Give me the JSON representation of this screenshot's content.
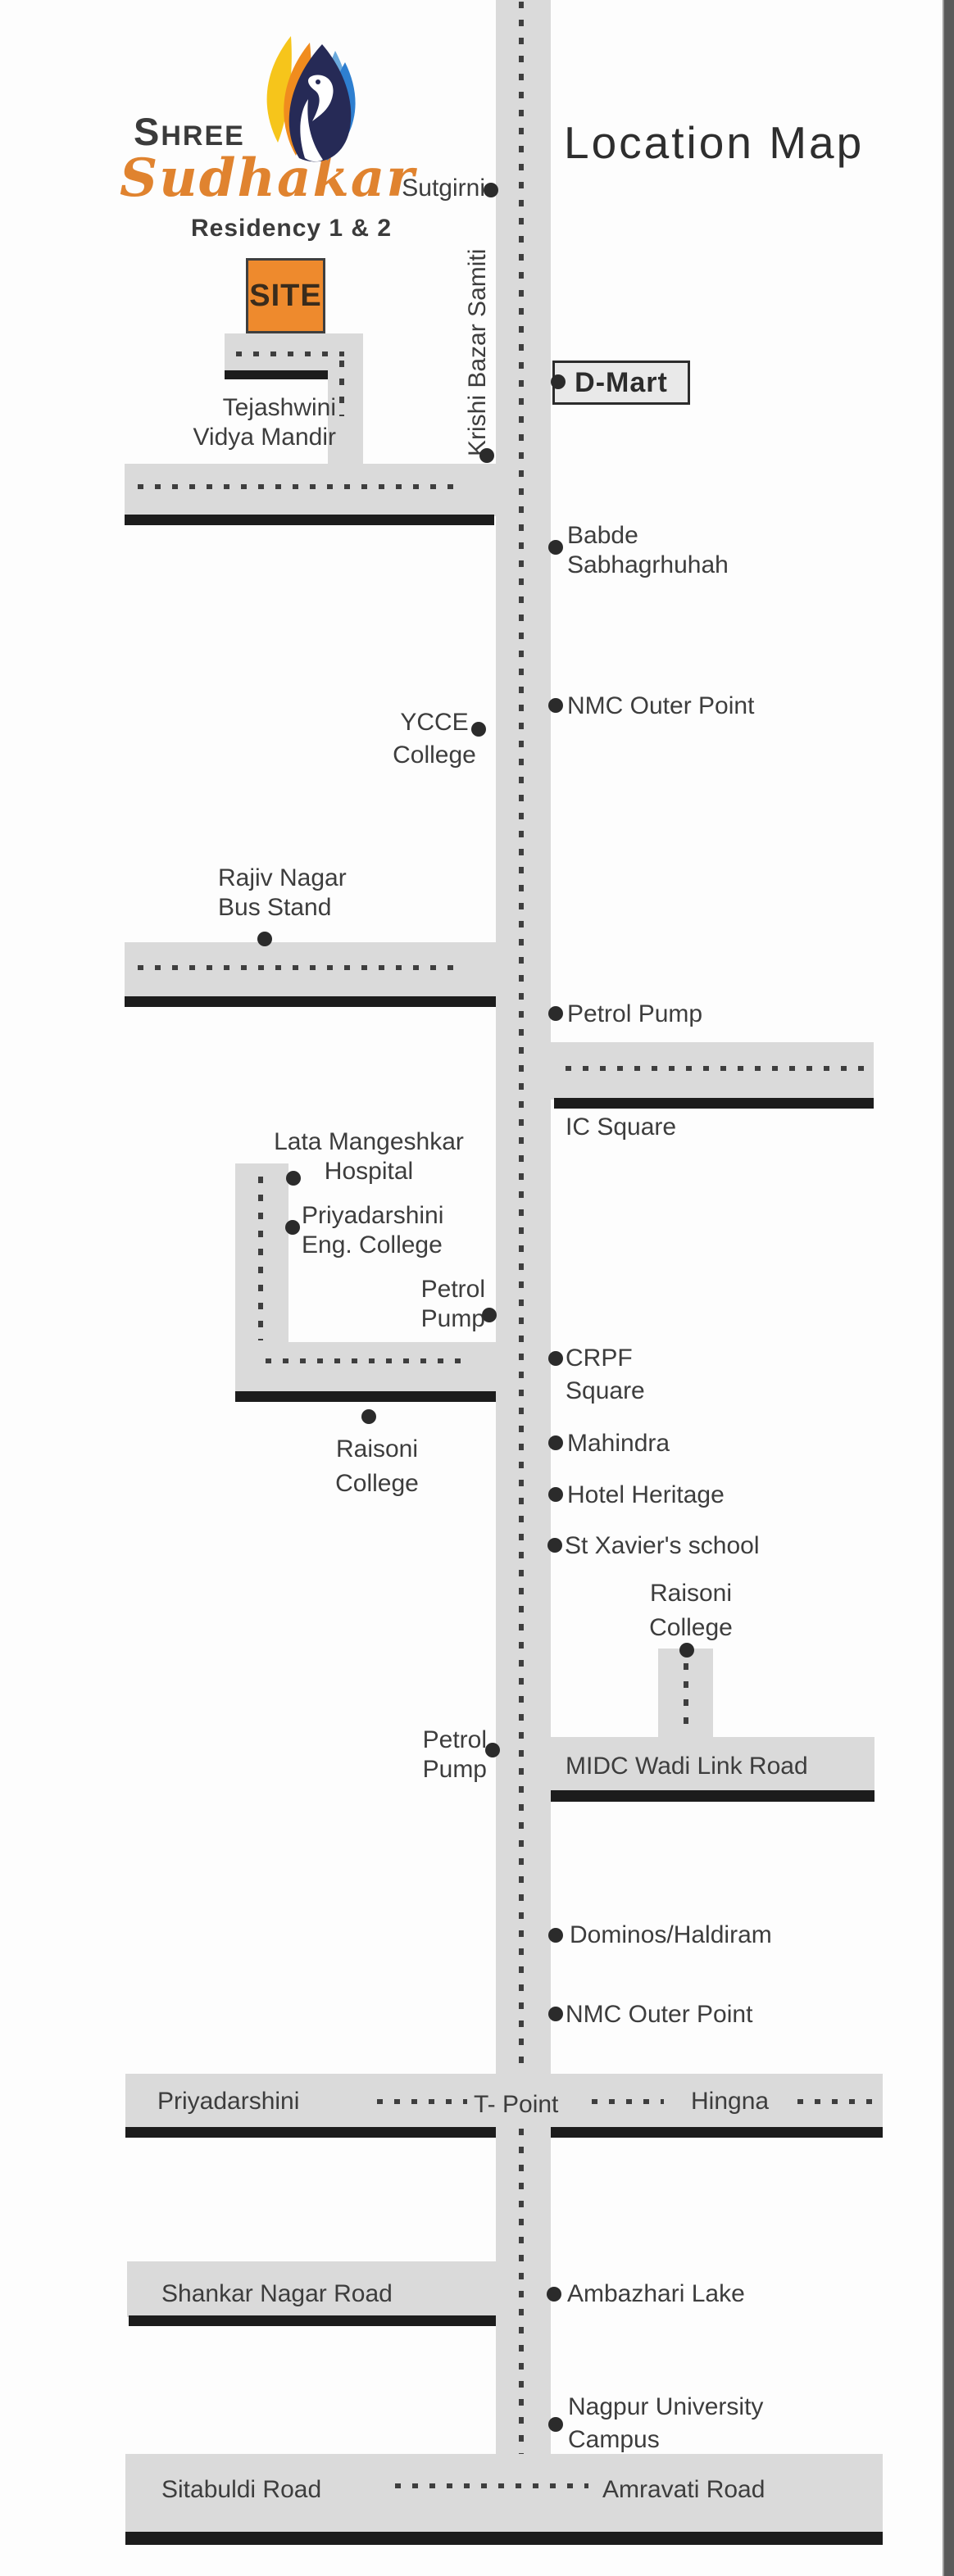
{
  "title": "Location Map",
  "branding": {
    "shree_initial": "S",
    "shree_rest": "HREE",
    "script": "Sudhakar",
    "residency": "Residency 1 & 2"
  },
  "site": {
    "label": "SITE"
  },
  "colors": {
    "road_fill": "#dadada",
    "black_line": "#1c1c1c",
    "dotted_line": "#3e3e3e",
    "bullet": "#2b2b2b",
    "text": "#3d3d3d",
    "site_orange": "#ee8a2d",
    "script_orange": "#e0832f",
    "logo_yellow": "#f6c51b",
    "logo_orange": "#f08c1e",
    "logo_navy": "#262a56",
    "logo_lightblue": "#6aa9dc",
    "logo_blue": "#2e7fd0"
  },
  "road_labels": {
    "krishi": "Krishi Bazar Samiti",
    "midc": "MIDC Wadi Link Road",
    "tpoint_left": "Priyadarshini",
    "tpoint_center": "T- Point",
    "tpoint_right": "Hingna",
    "shankar": "Shankar Nagar Road",
    "sitabuldi": "Sitabuldi Road",
    "amravati": "Amravati Road"
  },
  "landmarks": {
    "sutgirni": "Sutgirni",
    "dmart": "D-Mart",
    "tejashwini": "Tejashwini\nVidya Mandir",
    "babde": "Babde\nSabhagrhuhah",
    "nmc_outer_1": "NMC Outer Point",
    "ycce": "YCCE\nCollege",
    "rajiv": "Rajiv Nagar\nBus Stand",
    "petrol_pump_1": "Petrol Pump",
    "ic_square": "IC Square",
    "lata": "Lata Mangeshkar\nHospital",
    "priyadarshini_eng": "Priyadarshini\nEng. College",
    "petrol_pump_2": "Petrol\nPump",
    "crpf": "CRPF\nSquare",
    "raisoni_left": "Raisoni\nCollege",
    "mahindra": "Mahindra",
    "hotel_heritage": "Hotel Heritage",
    "st_xavier": "St Xavier's school",
    "raisoni_right": "Raisoni\nCollege",
    "petrol_pump_3": "Petrol\nPump",
    "dominos": "Dominos/Haldiram",
    "nmc_outer_2": "NMC Outer Point",
    "ambazhari": "Ambazhari Lake",
    "nagpur_university": "Nagpur University\nCampus"
  }
}
